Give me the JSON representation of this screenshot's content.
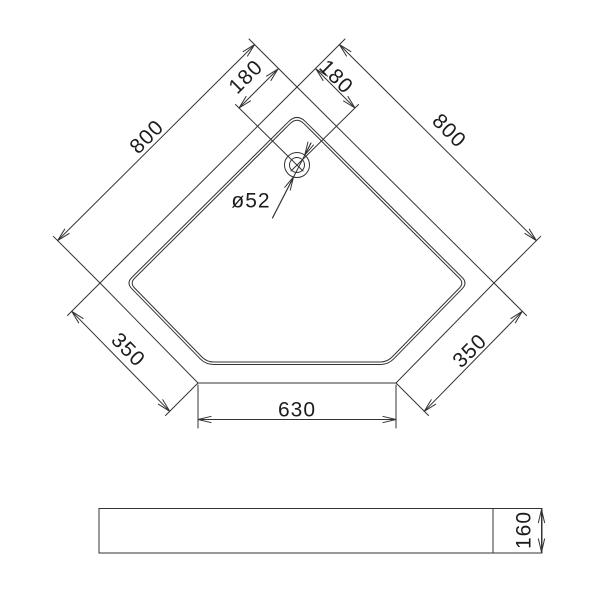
{
  "drawing": {
    "top_view": {
      "dim_side_left": "800",
      "dim_side_right": "800",
      "dim_top_offset_left": "180",
      "dim_top_offset_right": "180",
      "dim_corner_left": "350",
      "dim_corner_right": "350",
      "dim_bottom_width": "630",
      "drain_diameter_label": "ø52"
    },
    "side_view": {
      "dim_height": "160"
    }
  },
  "colors": {
    "line": "#333333",
    "text": "#1c1c1c",
    "background": "#ffffff"
  }
}
